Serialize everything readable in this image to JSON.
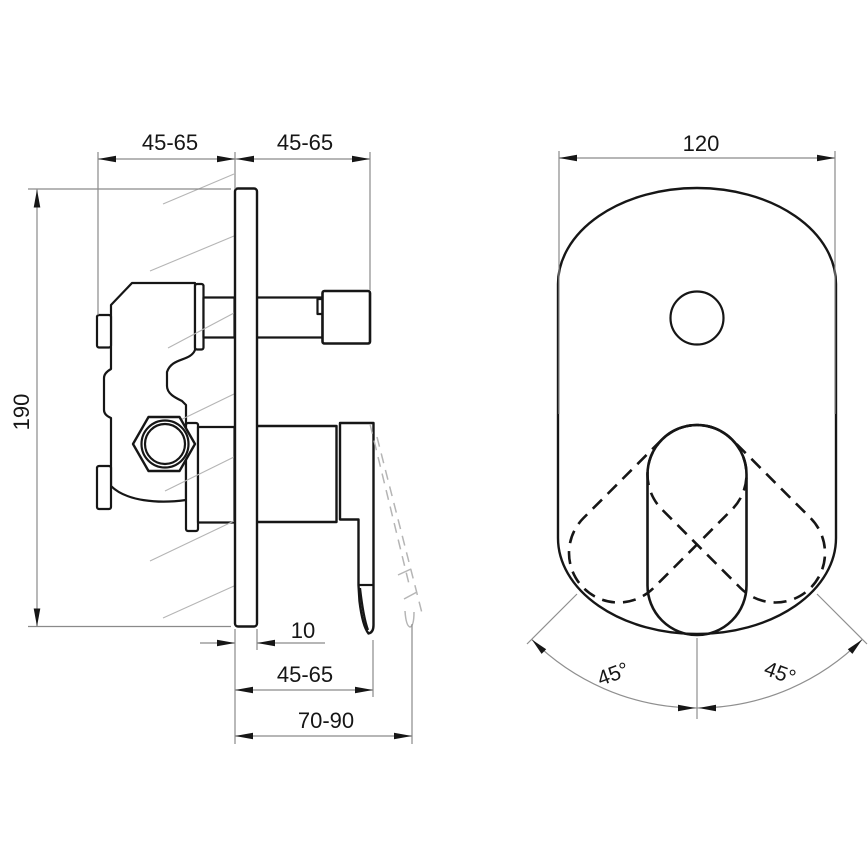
{
  "colors": {
    "line": "#161616",
    "dim": "#8a8a8a",
    "aux": "#8f8f8f",
    "ghost": "#b5b5b5",
    "background": "#ffffff"
  },
  "side_view": {
    "offset_left": "45-65",
    "offset_right": "45-65",
    "height": "190",
    "plate_thickness": "10",
    "handle_depth": "45-65",
    "total_depth": "70-90"
  },
  "front_view": {
    "width": "120",
    "angle_left": "45°",
    "angle_right": "45°"
  }
}
